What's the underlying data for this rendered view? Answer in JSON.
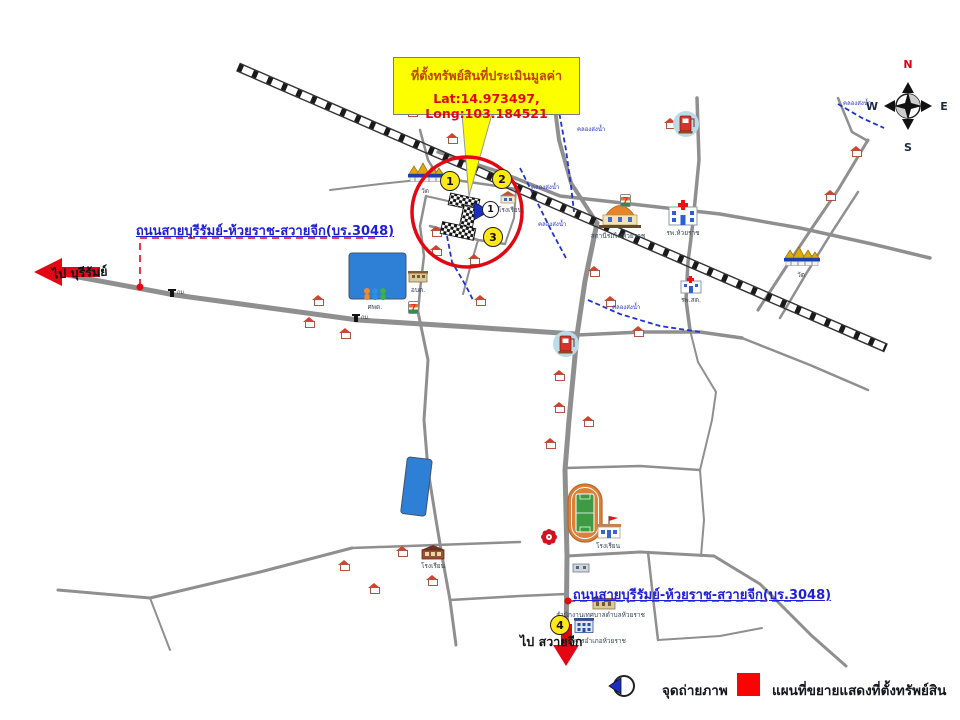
{
  "callout": {
    "title": "ที่ตั้งทรัพย์สินที่ประเมินมูลค่า",
    "coords": "Lat:14.973497, Long:103.184521"
  },
  "roads": {
    "label_west": "ถนนสายบุรีรัมย์-ห้วยราช-สวายจีก(บร.3048)",
    "label_south": "ถนนสายบุรีรัมย์-ห้วยราช-สวายจีก(บร.3048)"
  },
  "directions": {
    "to_buriram": "ไป บุรีรัมย์",
    "to_sawai_chik": "ไป สวายจีก"
  },
  "compass": {
    "n": "N",
    "e": "E",
    "s": "S",
    "w": "W"
  },
  "markers": {
    "m1": "1",
    "m2": "2",
    "m3": "3",
    "m4": "4",
    "photo": "1"
  },
  "poi": {
    "temple_west": "วัด",
    "temple_east": "วัด",
    "station": "สถานีรถไฟห้วยราช",
    "hospital": "รพ.ห้วยราช",
    "health_center": "รพ.สต.",
    "school_circle": "โรงเรียน",
    "school_south": "โรงเรียน",
    "school_stadium": "โรงเรียน",
    "kindergarten": "ศพด.",
    "subdistrict_office": "อบต.",
    "municipal_office": "สำนักงานเทศบาลตำบลห้วยราช",
    "district_office": "ที่ว่าการอำเภอห้วยราช",
    "stream": "คลองส่งน้ำ",
    "km_marker": "กม."
  },
  "legend": {
    "photo_point": "จุดถ่ายภาพ",
    "property_map": "แผนที่ขยายแสดงที่ตั้งทรัพย์สิน"
  },
  "colors": {
    "highlight": "#e30613",
    "road_label_blue": "#1f1fd8",
    "callout_bg": "#fdff00",
    "water": "#2e7fd6",
    "legend_box": "#fb0300"
  }
}
